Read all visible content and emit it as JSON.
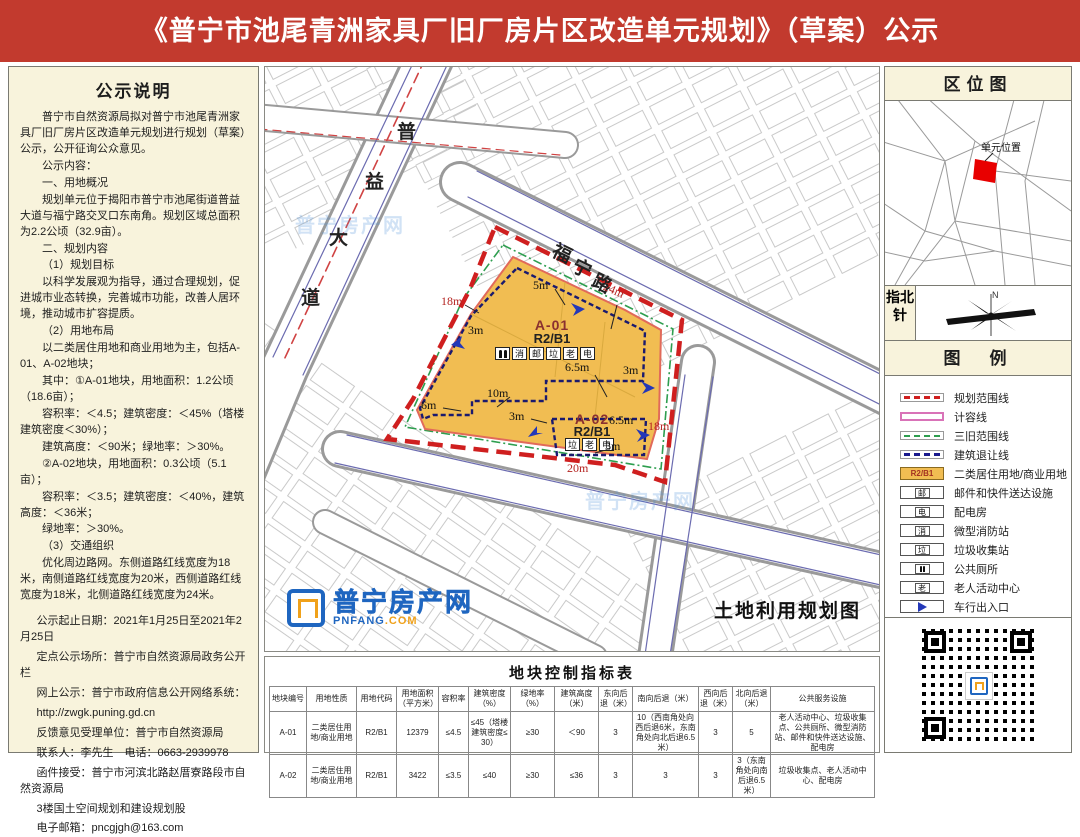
{
  "banner": {
    "title": "《普宁市池尾青洲家具厂旧厂房片区改造单元规划》（草案）公示"
  },
  "notice": {
    "heading": "公示说明",
    "paragraphs": [
      "普宁市自然资源局拟对普宁市池尾青洲家具厂旧厂房片区改造单元规划进行规划（草案）公示，公开征询公众意见。",
      "公示内容：",
      "一、用地概况",
      "规划单元位于揭阳市普宁市池尾街道普益大道与福宁路交叉口东南角。规划区域总面积为2.2公顷（32.9亩）。",
      "二、规划内容",
      "（1）规划目标",
      "以科学发展观为指导，通过合理规划，促进城市业态转换，完善城市功能，改善人居环境，推动城市扩容提质。",
      "（2）用地布局",
      "以二类居住用地和商业用地为主，包括A-01、A-02地块；",
      "其中：①A-01地块，用地面积：1.2公顷（18.6亩）；",
      "容积率：＜4.5；建筑密度：＜45%（塔楼建筑密度＜30%）；",
      "建筑高度：＜90米；绿地率：＞30%。",
      "②A-02地块，用地面积：0.3公顷（5.1亩）；",
      "容积率：＜3.5；建筑密度：＜40%，建筑高度：＜36米；",
      "绿地率：＞30%。",
      "（3）交通组织",
      "优化周边路网。东侧道路红线宽度为18米，南侧道路红线宽度为20米，西侧道路红线宽度为18米，北侧道路红线宽度为24米。"
    ],
    "contact_lines": [
      "公示起止日期：2021年1月25日至2021年2月25日",
      "定点公示场所：普宁市自然资源局政务公开栏",
      "网上公示：普宁市政府信息公开网络系统：",
      "http://zwgk.puning.gd.cn",
      "反馈意见受理单位：普宁市自然资源局",
      "联系人：李先生　电话：0663-2939978",
      "函件接受：普宁市河滨北路赵厝寮路段市自然资源局",
      "3楼国土空间规划和建设规划股",
      "电子邮箱：pncgjgh@163.com"
    ]
  },
  "map": {
    "title": "土地利用规划图",
    "roads": {
      "puyi": [
        "普",
        "益",
        "大",
        "道"
      ],
      "funing": [
        "福",
        "宁",
        "路"
      ]
    },
    "parcels": {
      "a01": {
        "code": "A-01",
        "use": "R2/B1",
        "facilities": [
          "消",
          "邮",
          "垃",
          "老",
          "电"
        ]
      },
      "a02": {
        "code": "A-02",
        "use": "R2/B1",
        "facilities": [
          "垃",
          "老",
          "电"
        ]
      }
    },
    "dims": [
      "18m",
      "5m",
      "24m",
      "3m",
      "6.5m",
      "3m",
      "10m",
      "6m",
      "3m",
      "6.5m",
      "18m",
      "3m",
      "20m"
    ],
    "watermark": {
      "name": "普宁房产网",
      "domain": "PNFANG",
      "domain_tld": ".COM"
    }
  },
  "sidebar": {
    "location": {
      "heading": "区位图",
      "unit_label": "单元位置"
    },
    "compass": {
      "heading": "指北针",
      "north": "N"
    },
    "legend": {
      "heading": "图　例",
      "items": [
        {
          "label": "规划范围线"
        },
        {
          "label": "计容线"
        },
        {
          "label": "三旧范围线"
        },
        {
          "label": "建筑退让线"
        },
        {
          "glyph": "R2/B1",
          "label": "二类居住用地/商业用地"
        },
        {
          "glyph": "邮",
          "label": "邮件和快件送达设施"
        },
        {
          "glyph": "电",
          "label": "配电房"
        },
        {
          "glyph": "消",
          "label": "微型消防站"
        },
        {
          "glyph": "垃",
          "label": "垃圾收集站"
        },
        {
          "label": "公共厕所"
        },
        {
          "glyph": "老",
          "label": "老人活动中心"
        },
        {
          "label": "车行出入口"
        }
      ]
    }
  },
  "table": {
    "title": "地块控制指标表",
    "headers": [
      "地块编号",
      "用地性质",
      "用地代码",
      "用地面积（平方米）",
      "容积率",
      "建筑密度（%）",
      "绿地率（%）",
      "建筑高度（米）",
      "东向后退（米）",
      "南向后退（米）",
      "西向后退（米）",
      "北向后退（米）",
      "公共服务设施"
    ],
    "rows": [
      [
        "A-01",
        "二类居住用地/商业用地",
        "R2/B1",
        "12379",
        "≤4.5",
        "≤45（塔楼建筑密度≤30）",
        "≥30",
        "＜90",
        "3",
        "10（西南角处向西后退6米，东南角处向北后退6.5米）",
        "3",
        "5",
        "老人活动中心、垃圾收集点、公共厕所、微型消防站、邮件和快件送达设施、配电房"
      ],
      [
        "A-02",
        "二类居住用地/商业用地",
        "R2/B1",
        "3422",
        "≤3.5",
        "≤40",
        "≥30",
        "≤36",
        "3",
        "3",
        "3",
        "3（东南角处向南后退6.5米）",
        "垃圾收集点、老人活动中心、配电房"
      ]
    ]
  }
}
